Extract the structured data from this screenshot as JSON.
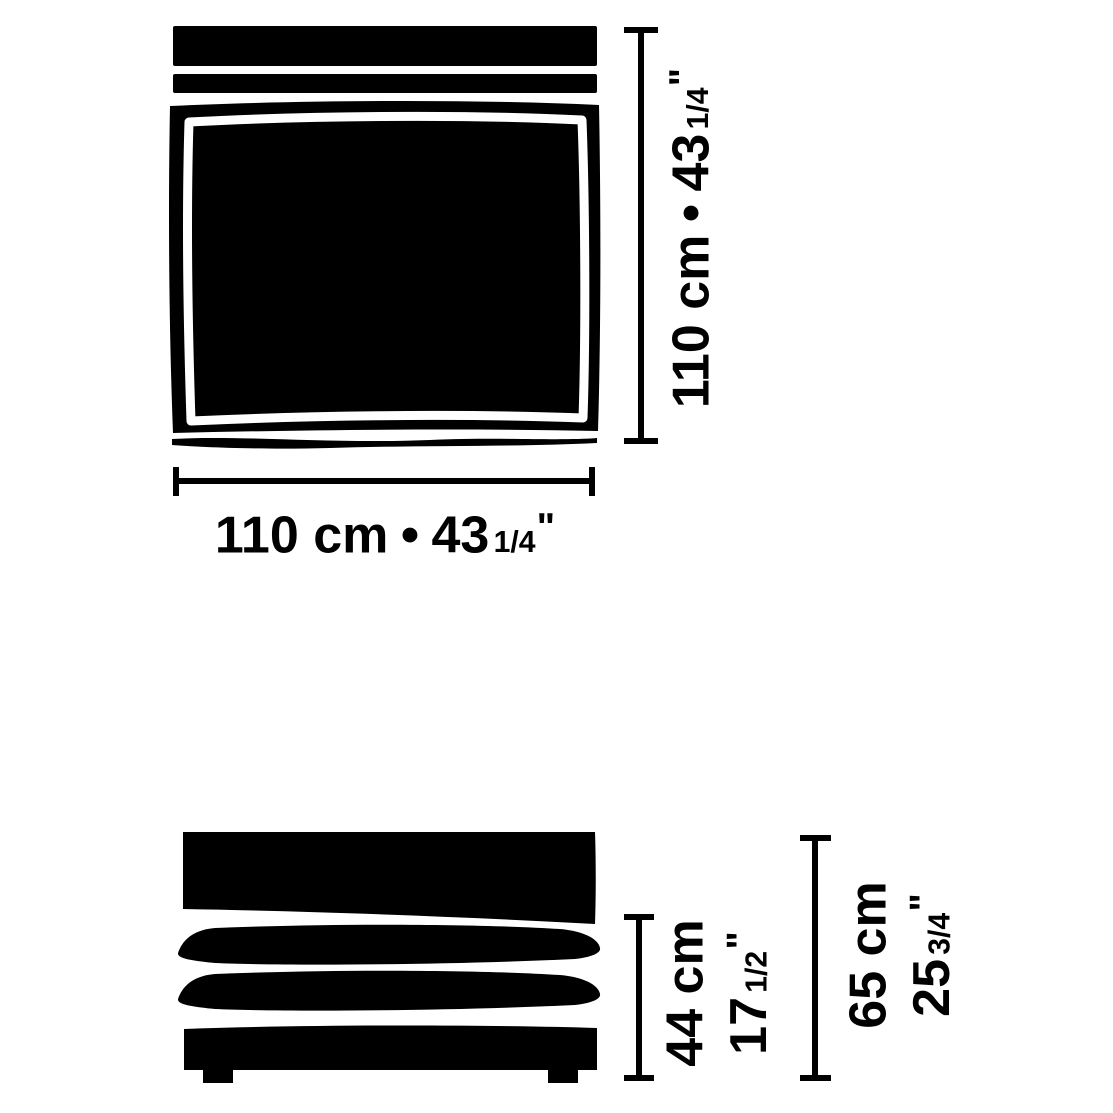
{
  "colors": {
    "ink": "#000000",
    "background": "#ffffff"
  },
  "top_view": {
    "width_dim": {
      "metric": "110 cm",
      "separator": "•",
      "imperial_whole": "43",
      "imperial_fraction": "1/4",
      "inch_mark": "\""
    },
    "height_dim": {
      "metric": "110 cm",
      "separator": "•",
      "imperial_whole": "43",
      "imperial_fraction": "1/4",
      "inch_mark": "\""
    }
  },
  "front_view": {
    "seat_height_dim": {
      "metric": "44 cm",
      "imperial_whole": "17",
      "imperial_fraction": "1/2",
      "inch_mark": "\""
    },
    "overall_height_dim": {
      "metric": "65 cm",
      "imperial_whole": "25",
      "imperial_fraction": "3/4",
      "inch_mark": "\""
    }
  }
}
